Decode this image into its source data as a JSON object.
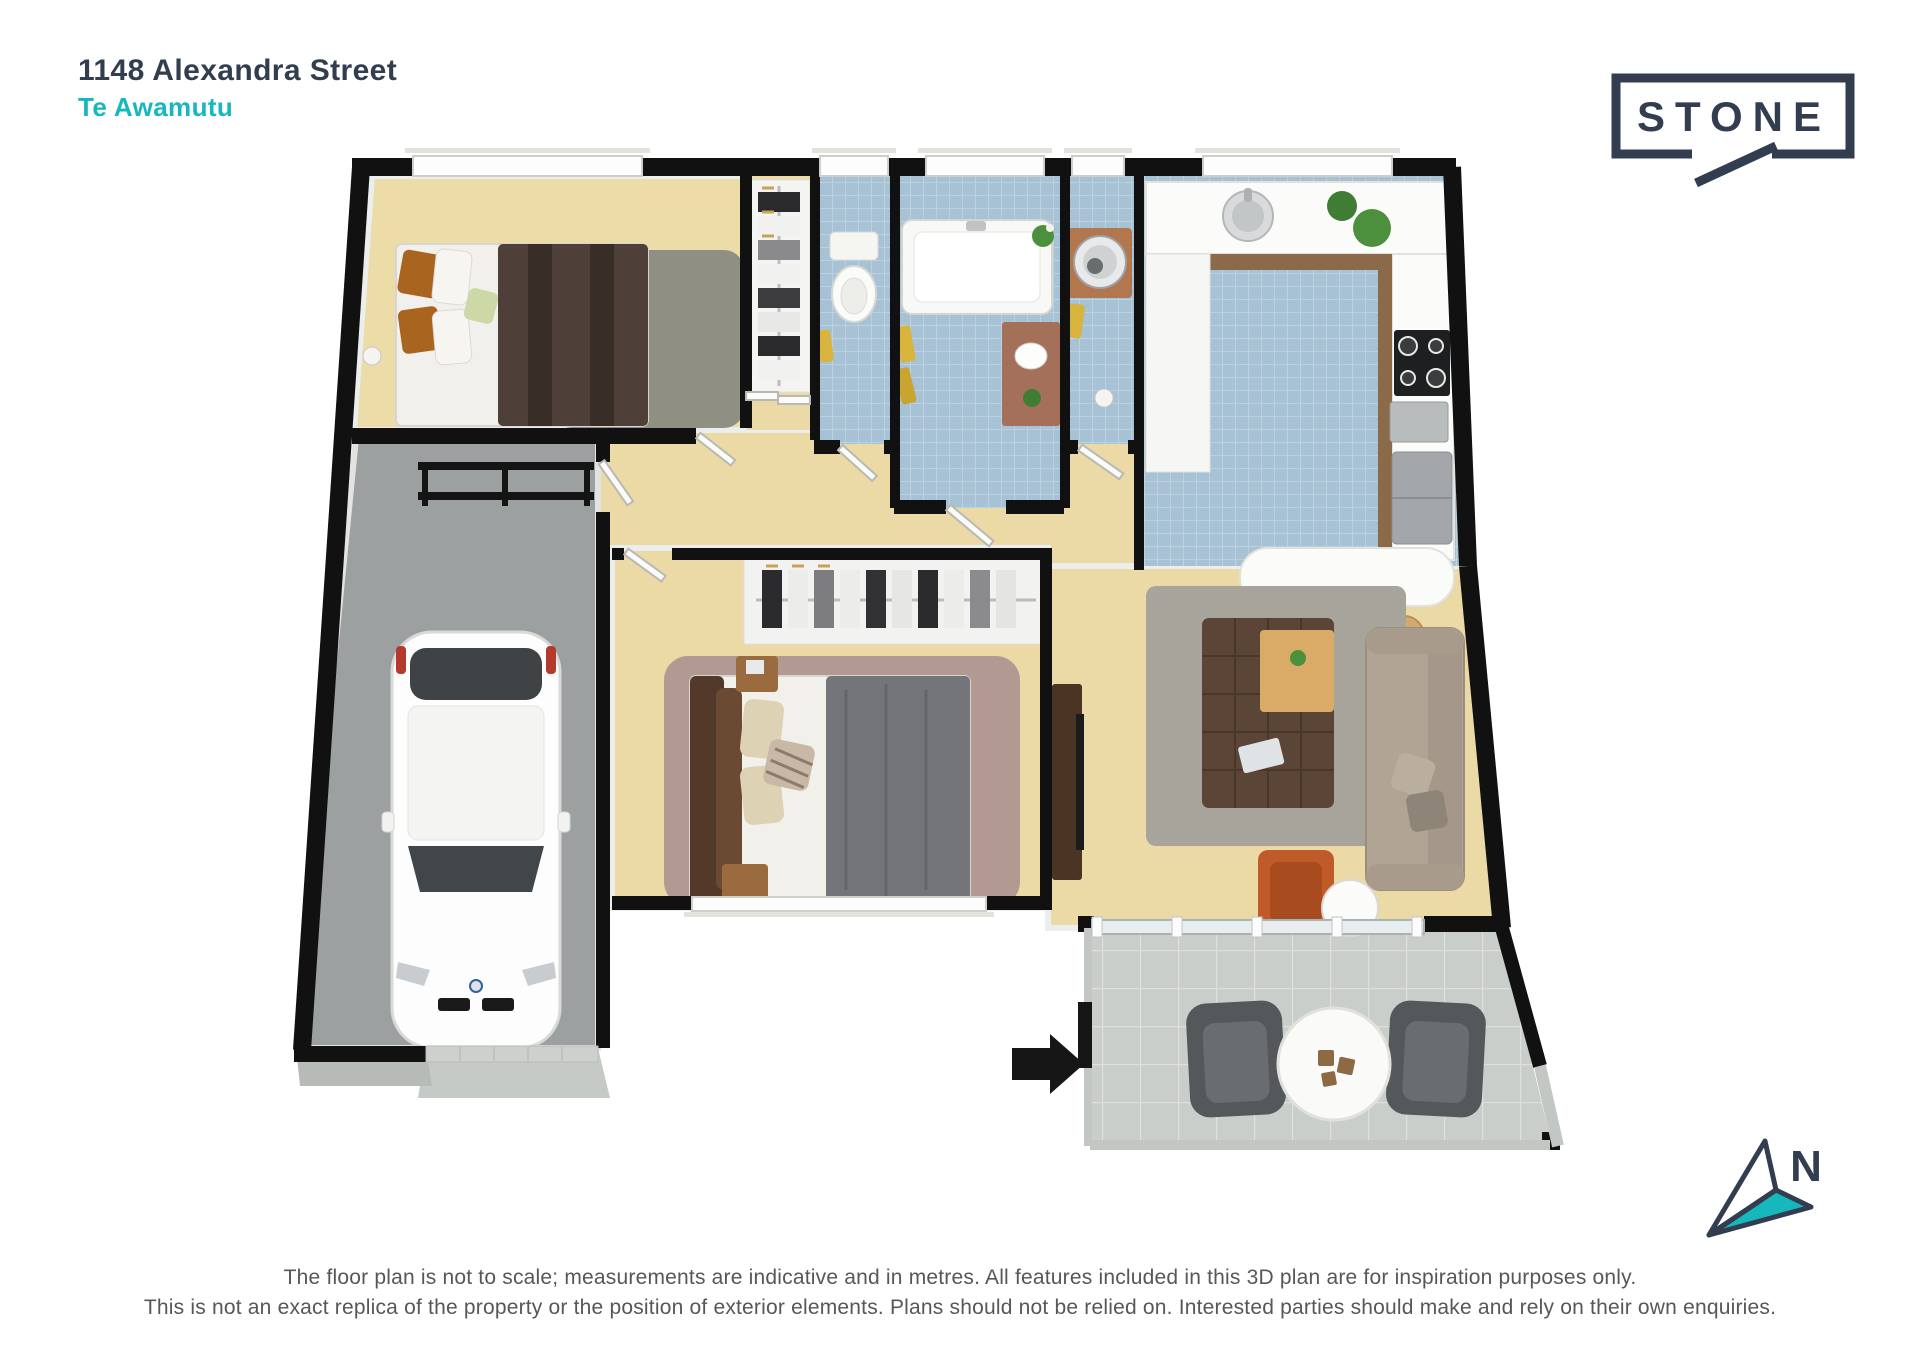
{
  "header": {
    "address": "1148 Alexandra Street",
    "suburb": "Te Awamutu"
  },
  "brand": {
    "name": "STONE"
  },
  "compass": {
    "label": "N"
  },
  "footer": {
    "line1": "The floor plan is not to scale; measurements are indicative and in metres. All features included in this 3D plan are for inspiration purposes only.",
    "line2": "This is not an exact replica of the property or the position of exterior elements. Plans should not be relied on. Interested parties should make and rely on their own enquiries."
  },
  "colors": {
    "brand_navy": "#323e4f",
    "accent_teal": "#16b8bd",
    "wall_black": "#111111",
    "carpet_tan": "#ebd9a6",
    "tile_blue": "#a8c2d5",
    "garage_gray": "#9da0a0",
    "patio_gray": "#caceca",
    "footer_gray": "#55575a"
  },
  "floorplan": {
    "rooms": [
      "bedroom-1",
      "wardrobe-1",
      "toilet",
      "bathroom",
      "laundry",
      "kitchen",
      "hallway",
      "garage",
      "wardrobe-2",
      "bedroom-2",
      "living-room",
      "patio"
    ]
  }
}
